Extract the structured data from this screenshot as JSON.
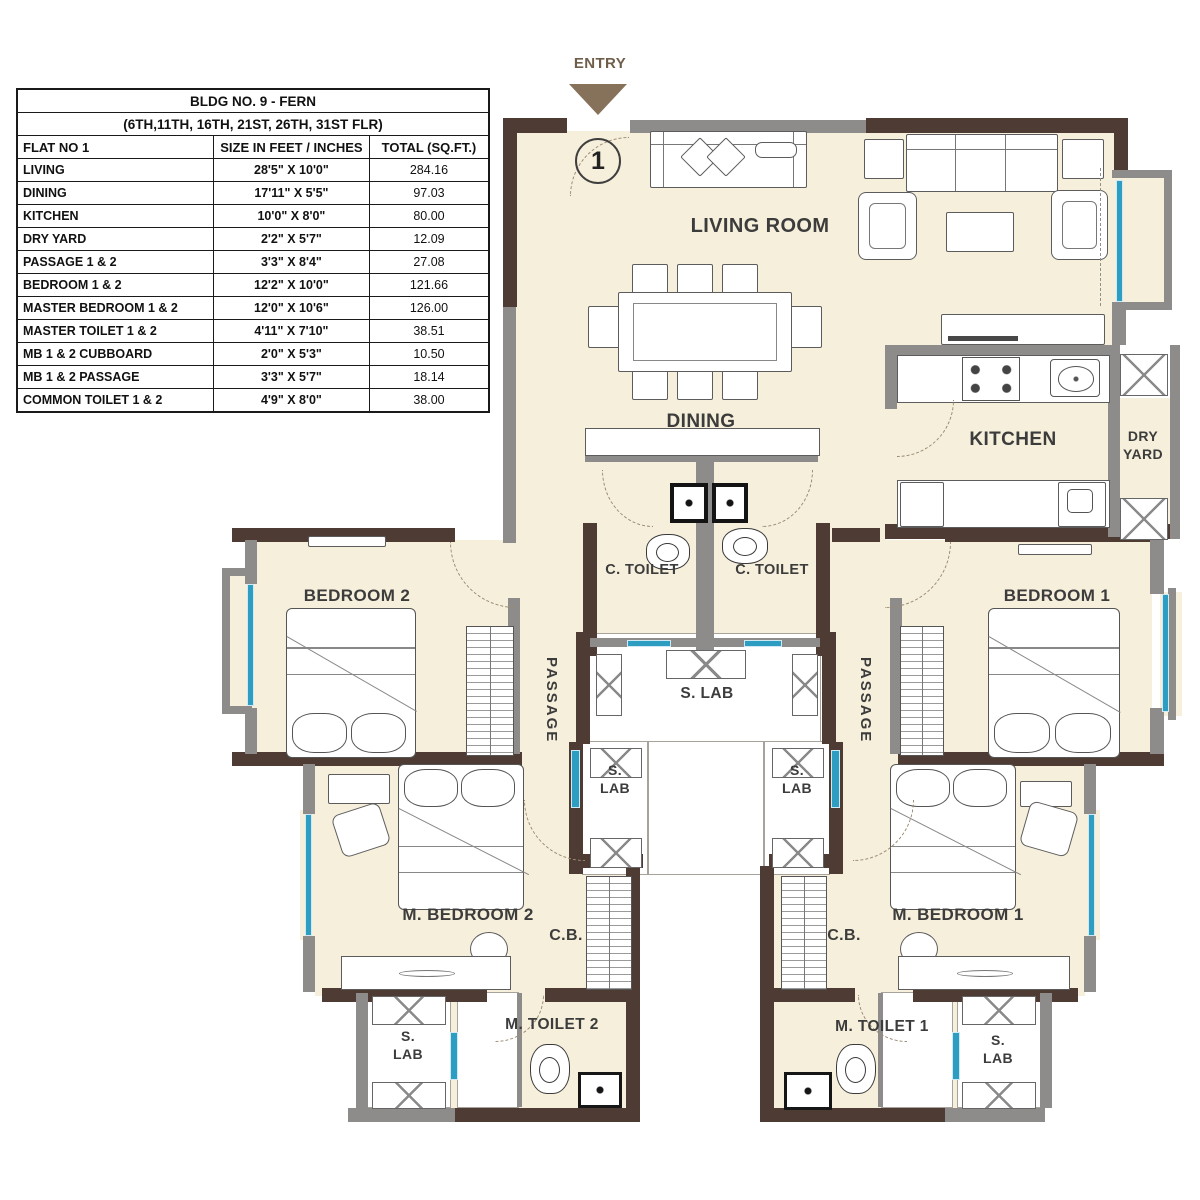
{
  "table": {
    "title": "BLDG NO. 9 - FERN",
    "subtitle": "(6TH,11TH, 16TH, 21ST, 26TH, 31ST FLR)",
    "headers": [
      "FLAT NO 1",
      "SIZE IN FEET / INCHES",
      "TOTAL (SQ.FT.)"
    ],
    "rows": [
      {
        "room": "LIVING",
        "size": "28'5\" X 10'0\"",
        "total": "284.16"
      },
      {
        "room": "DINING",
        "size": "17'11\" X 5'5\"",
        "total": "97.03"
      },
      {
        "room": "KITCHEN",
        "size": "10'0\" X 8'0\"",
        "total": "80.00"
      },
      {
        "room": "DRY YARD",
        "size": "2'2\" X 5'7\"",
        "total": "12.09"
      },
      {
        "room": "PASSAGE 1 & 2",
        "size": "3'3\" X 8'4\"",
        "total": "27.08"
      },
      {
        "room": "BEDROOM 1 & 2",
        "size": "12'2\" X 10'0\"",
        "total": "121.66"
      },
      {
        "room": "MASTER BEDROOM 1 & 2",
        "size": "12'0\" X 10'6\"",
        "total": "126.00"
      },
      {
        "room": "MASTER TOILET 1 & 2",
        "size": "4'11\" X 7'10\"",
        "total": "38.51"
      },
      {
        "room": "MB 1 & 2 CUBBOARD",
        "size": "2'0\" X 5'3\"",
        "total": "10.50"
      },
      {
        "room": "MB 1 & 2 PASSAGE",
        "size": "3'3\" X 5'7\"",
        "total": "18.14"
      },
      {
        "room": "COMMON TOILET 1 & 2",
        "size": "4'9\" X 8'0\"",
        "total": "38.00"
      }
    ]
  },
  "entry": {
    "label": "ENTRY"
  },
  "flat_marker": {
    "number": "1"
  },
  "labels": {
    "living_room": "LIVING ROOM",
    "dining": "DINING",
    "kitchen": "KITCHEN",
    "dry_yard": "DRY YARD",
    "c_toilet": "C. TOILET",
    "bedroom_2": "BEDROOM 2",
    "bedroom_1": "BEDROOM 1",
    "passage": "PASSAGE",
    "s_lab": "S. LAB",
    "m_bedroom_2": "M. BEDROOM 2",
    "m_bedroom_1": "M. BEDROOM 1",
    "cb": "C.B.",
    "m_toilet_2": "M. TOILET 2",
    "m_toilet_1": "M. TOILET 1"
  },
  "colors": {
    "wall_dark": "#4e3b34",
    "wall_gray": "#8e8c8a",
    "floor": "#f6efdb",
    "window_blue": "#2d9ec2",
    "entry_brown": "#86715a",
    "label_text": "#3c3c3c"
  }
}
